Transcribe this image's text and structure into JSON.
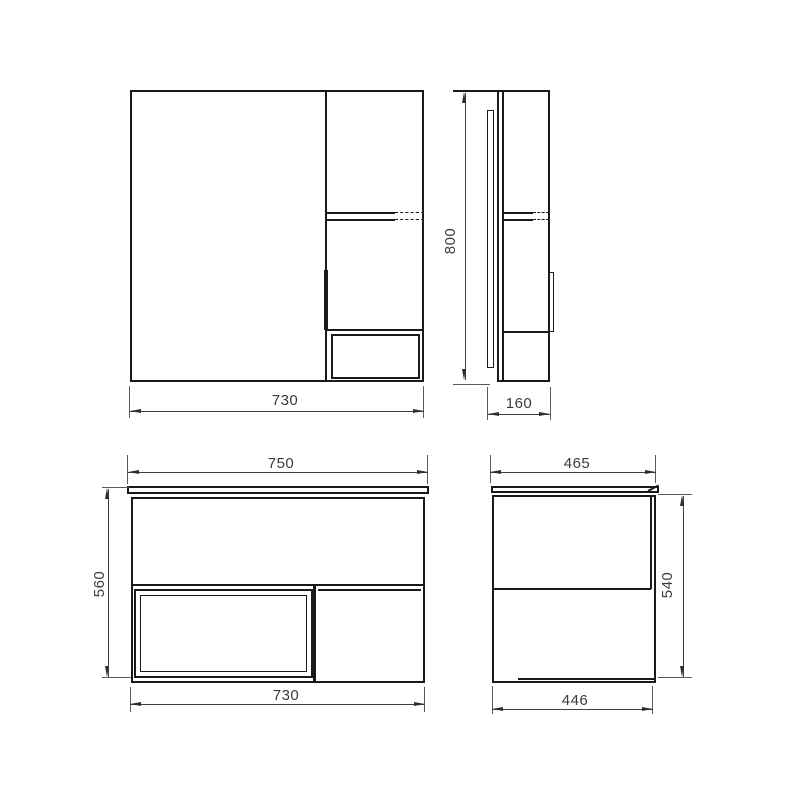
{
  "drawing": {
    "type": "technical-dimension-drawing",
    "colors": {
      "object_line": "#1a1a1a",
      "dimension_line": "#3f3f3f",
      "background": "#ffffff",
      "text": "#3b3b3b"
    },
    "views": {
      "mirror_front": {
        "dims": {
          "width": "730"
        }
      },
      "mirror_side": {
        "dims": {
          "height": "800",
          "depth": "160"
        }
      },
      "vanity_front": {
        "dims": {
          "top_width": "750",
          "height": "560",
          "bottom_width": "730"
        }
      },
      "vanity_side": {
        "dims": {
          "top_depth": "465",
          "height": "540",
          "bottom_depth": "446"
        }
      }
    }
  }
}
